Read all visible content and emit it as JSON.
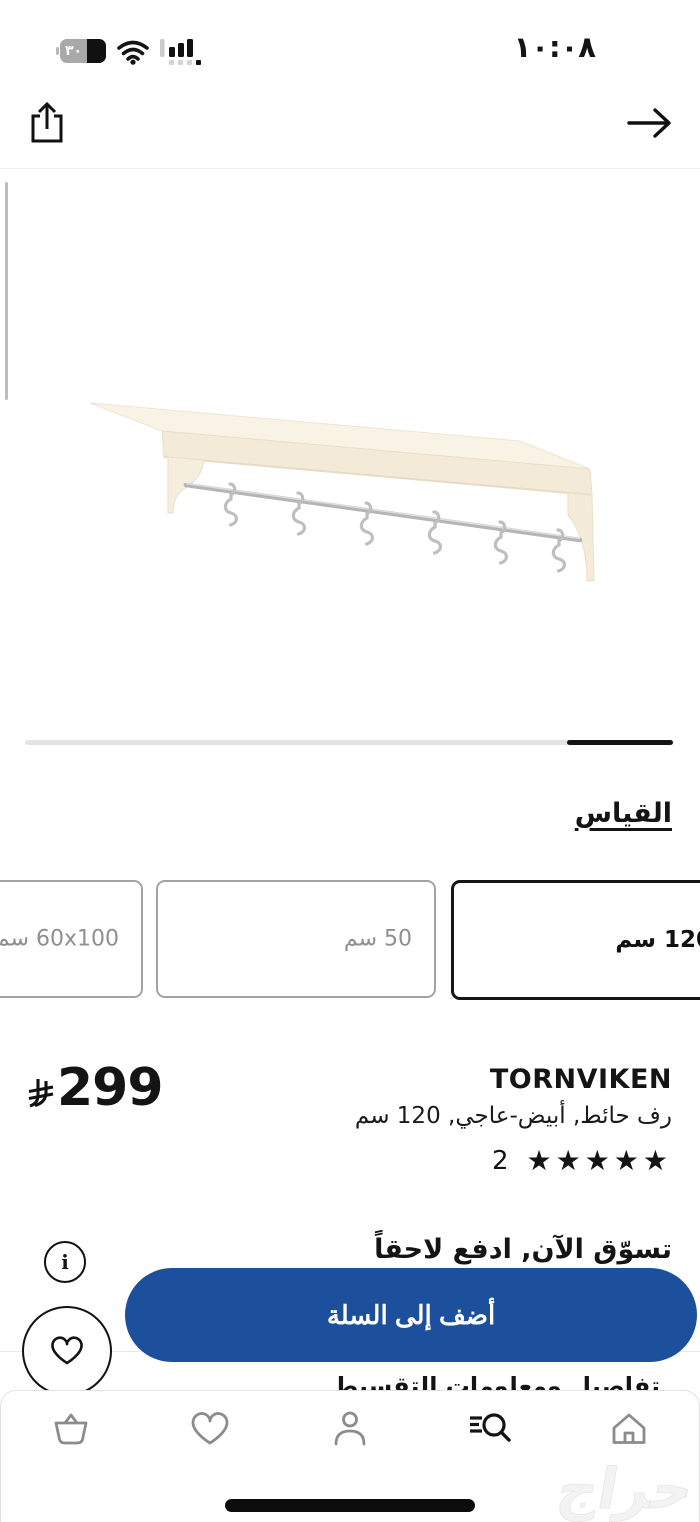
{
  "status_bar": {
    "time": "١٠:٠٨",
    "battery_percent": "٣٠"
  },
  "size_section": {
    "title": "القياس",
    "options": [
      {
        "label": "60x100 سم",
        "selected": false
      },
      {
        "label": "50 سم",
        "selected": false
      },
      {
        "label": "120 سم",
        "selected": true
      }
    ]
  },
  "product": {
    "name": "TORNVIKEN",
    "description": "رف حائط, أبيض-عاجي, 120 سم",
    "price": "299",
    "currency": "ريال سعودي",
    "rating_stars": "★★★★★",
    "rating_count": "2"
  },
  "bnpl": {
    "title": "تسوّق الآن, ادفع لاحقاً",
    "details_text": "تفاصيل ومعلومات التقسيط"
  },
  "actions": {
    "add_to_cart_label": "أضف إلى السلة",
    "info_glyph": "i"
  },
  "bottom_nav": {
    "items": [
      "cart",
      "wishlist",
      "profile",
      "search",
      "home"
    ],
    "active": "search"
  },
  "watermark": "حراج",
  "colors": {
    "accent_blue": "#1c4f9c",
    "selected_border": "#151515",
    "inactive_gray": "#8f8f8f",
    "product_cream": "#f8f1e2"
  }
}
